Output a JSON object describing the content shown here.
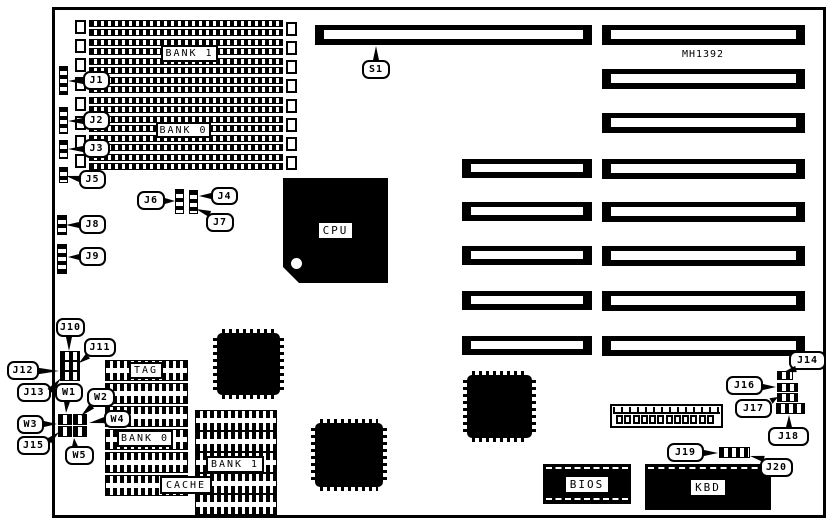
{
  "title": "MH1392 motherboard jumper and connector location diagram",
  "board": {
    "part_number": "MH1392",
    "part_number_pos": {
      "x": 672,
      "y": 49,
      "w": 62,
      "h": 14
    },
    "outline": {
      "x": 52,
      "y": 7,
      "w": 774,
      "h": 511
    },
    "ink_color": "#000000",
    "background_color": "#ffffff"
  },
  "memory": {
    "row": {
      "x": 75,
      "w": 222,
      "h": 16
    },
    "rows_y": [
      20,
      39,
      58,
      77,
      97,
      116,
      135,
      154
    ],
    "labels": [
      {
        "text": "BANK 1",
        "x": 161,
        "y": 45,
        "w": 57,
        "h": 17
      },
      {
        "text": "BANK 0",
        "x": 156,
        "y": 122,
        "w": 55,
        "h": 16
      }
    ]
  },
  "expansion_slots": [
    {
      "x": 315,
      "y": 25,
      "w": 277,
      "h": 20
    },
    {
      "x": 602,
      "y": 25,
      "w": 203,
      "h": 20
    },
    {
      "x": 602,
      "y": 69,
      "w": 203,
      "h": 20
    },
    {
      "x": 602,
      "y": 113,
      "w": 203,
      "h": 20
    },
    {
      "x": 462,
      "y": 159,
      "w": 130,
      "h": 19
    },
    {
      "x": 602,
      "y": 159,
      "w": 203,
      "h": 20
    },
    {
      "x": 462,
      "y": 202,
      "w": 130,
      "h": 19
    },
    {
      "x": 602,
      "y": 202,
      "w": 203,
      "h": 20
    },
    {
      "x": 462,
      "y": 246,
      "w": 130,
      "h": 19
    },
    {
      "x": 602,
      "y": 246,
      "w": 203,
      "h": 20
    },
    {
      "x": 462,
      "y": 291,
      "w": 130,
      "h": 19
    },
    {
      "x": 602,
      "y": 291,
      "w": 203,
      "h": 20
    },
    {
      "x": 462,
      "y": 336,
      "w": 130,
      "h": 19
    },
    {
      "x": 602,
      "y": 336,
      "w": 203,
      "h": 20
    }
  ],
  "chips": {
    "cpu": {
      "label": "CPU",
      "x": 283,
      "y": 178,
      "w": 105,
      "h": 105
    },
    "qfp": [
      {
        "x": 217,
        "y": 333,
        "w": 63,
        "h": 62
      },
      {
        "x": 315,
        "y": 423,
        "w": 68,
        "h": 64
      },
      {
        "x": 467,
        "y": 375,
        "w": 65,
        "h": 63
      }
    ],
    "bios": {
      "label": "BIOS",
      "x": 543,
      "y": 464,
      "w": 88,
      "h": 40
    },
    "kbd": {
      "label": "KBD",
      "x": 645,
      "y": 464,
      "w": 126,
      "h": 46
    }
  },
  "cache": {
    "rows": [
      {
        "x": 105,
        "y": 360,
        "w": 83,
        "h": 21
      },
      {
        "x": 105,
        "y": 383,
        "w": 83,
        "h": 21
      },
      {
        "x": 105,
        "y": 406,
        "w": 83,
        "h": 21
      },
      {
        "x": 105,
        "y": 429,
        "w": 83,
        "h": 21
      },
      {
        "x": 105,
        "y": 452,
        "w": 83,
        "h": 21
      },
      {
        "x": 105,
        "y": 475,
        "w": 83,
        "h": 21
      },
      {
        "x": 195,
        "y": 410,
        "w": 82,
        "h": 21
      },
      {
        "x": 195,
        "y": 431,
        "w": 82,
        "h": 21
      },
      {
        "x": 195,
        "y": 452,
        "w": 82,
        "h": 21
      },
      {
        "x": 195,
        "y": 473,
        "w": 82,
        "h": 21
      },
      {
        "x": 195,
        "y": 494,
        "w": 82,
        "h": 21
      }
    ],
    "labels": [
      {
        "text": "TAG",
        "x": 129,
        "y": 362,
        "w": 34,
        "h": 17
      },
      {
        "text": "BANK 0",
        "x": 117,
        "y": 430,
        "w": 56,
        "h": 17
      },
      {
        "text": "BANK 1",
        "x": 206,
        "y": 456,
        "w": 58,
        "h": 17
      },
      {
        "text": "CACHE",
        "x": 160,
        "y": 476,
        "w": 52,
        "h": 18
      }
    ]
  },
  "jumpers": [
    {
      "id": "J1",
      "dir": "v",
      "x": 59,
      "y": 66,
      "w": 9,
      "h": 29
    },
    {
      "id": "J2",
      "dir": "v",
      "x": 59,
      "y": 107,
      "w": 9,
      "h": 27
    },
    {
      "id": "J3",
      "dir": "v",
      "x": 59,
      "y": 140,
      "w": 9,
      "h": 19
    },
    {
      "id": "J5",
      "dir": "v",
      "x": 59,
      "y": 167,
      "w": 9,
      "h": 16
    },
    {
      "id": "J6",
      "dir": "v",
      "x": 175,
      "y": 189,
      "w": 9,
      "h": 25
    },
    {
      "id": "J4-J7",
      "dir": "v",
      "x": 189,
      "y": 190,
      "w": 9,
      "h": 24
    },
    {
      "id": "J8",
      "dir": "v",
      "x": 57,
      "y": 215,
      "w": 10,
      "h": 20
    },
    {
      "id": "J9",
      "dir": "v",
      "x": 57,
      "y": 244,
      "w": 10,
      "h": 30
    },
    {
      "id": "J10-J13-row1",
      "dir": "h",
      "x": 60,
      "y": 351,
      "w": 20,
      "h": 10
    },
    {
      "id": "J10-J13-row2",
      "dir": "h",
      "x": 60,
      "y": 361,
      "w": 20,
      "h": 10
    },
    {
      "id": "J10-J13-row3",
      "dir": "h",
      "x": 60,
      "y": 371,
      "w": 20,
      "h": 10
    },
    {
      "id": "W-block-1",
      "dir": "h",
      "x": 58,
      "y": 414,
      "w": 14,
      "h": 11
    },
    {
      "id": "W-block-2",
      "dir": "h",
      "x": 73,
      "y": 414,
      "w": 14,
      "h": 11
    },
    {
      "id": "W-block-3",
      "dir": "h",
      "x": 58,
      "y": 426,
      "w": 14,
      "h": 11
    },
    {
      "id": "W-block-4",
      "dir": "h",
      "x": 73,
      "y": 426,
      "w": 14,
      "h": 11
    },
    {
      "id": "J14",
      "dir": "h",
      "x": 777,
      "y": 371,
      "w": 16,
      "h": 9
    },
    {
      "id": "J16",
      "dir": "h",
      "x": 777,
      "y": 383,
      "w": 21,
      "h": 9
    },
    {
      "id": "J17",
      "dir": "h",
      "x": 777,
      "y": 393,
      "w": 21,
      "h": 9
    },
    {
      "id": "J18",
      "dir": "h",
      "x": 776,
      "y": 403,
      "w": 29,
      "h": 11
    },
    {
      "id": "J19",
      "dir": "h",
      "x": 719,
      "y": 447,
      "w": 31,
      "h": 11
    }
  ],
  "connector": {
    "x": 610,
    "y": 404,
    "w": 113,
    "h": 24,
    "pin_count": 12
  },
  "callouts": [
    {
      "label": "S1",
      "x": 362,
      "y": 60,
      "w": 28,
      "h": 19,
      "from": [
        376,
        61
      ],
      "tip": [
        376,
        46
      ]
    },
    {
      "label": "J1",
      "x": 83,
      "y": 71,
      "w": 27,
      "h": 19,
      "from": [
        84,
        81
      ],
      "tip": [
        68,
        81
      ]
    },
    {
      "label": "J2",
      "x": 83,
      "y": 111,
      "w": 27,
      "h": 19,
      "from": [
        84,
        121
      ],
      "tip": [
        68,
        121
      ]
    },
    {
      "label": "J3",
      "x": 83,
      "y": 139,
      "w": 27,
      "h": 19,
      "from": [
        84,
        149
      ],
      "tip": [
        68,
        149
      ]
    },
    {
      "label": "J5",
      "x": 79,
      "y": 170,
      "w": 27,
      "h": 19,
      "from": [
        80,
        179
      ],
      "tip": [
        66,
        176
      ]
    },
    {
      "label": "J6",
      "x": 137,
      "y": 191,
      "w": 28,
      "h": 19,
      "from": [
        164,
        201
      ],
      "tip": [
        175,
        201
      ]
    },
    {
      "label": "J4",
      "x": 211,
      "y": 187,
      "w": 27,
      "h": 18,
      "from": [
        212,
        196
      ],
      "tip": [
        199,
        196
      ]
    },
    {
      "label": "J7",
      "x": 206,
      "y": 213,
      "w": 28,
      "h": 19,
      "from": [
        210,
        214
      ],
      "tip": [
        196,
        209
      ]
    },
    {
      "label": "J8",
      "x": 79,
      "y": 215,
      "w": 27,
      "h": 19,
      "from": [
        80,
        225
      ],
      "tip": [
        66,
        225
      ]
    },
    {
      "label": "J9",
      "x": 79,
      "y": 247,
      "w": 27,
      "h": 19,
      "from": [
        80,
        257
      ],
      "tip": [
        68,
        257
      ]
    },
    {
      "label": "J10",
      "x": 56,
      "y": 318,
      "w": 29,
      "h": 19,
      "from": [
        69,
        336
      ],
      "tip": [
        69,
        351
      ]
    },
    {
      "label": "J11",
      "x": 84,
      "y": 338,
      "w": 32,
      "h": 19,
      "from": [
        88,
        356
      ],
      "tip": [
        79,
        363
      ]
    },
    {
      "label": "J12",
      "x": 7,
      "y": 361,
      "w": 32,
      "h": 19,
      "from": [
        38,
        371
      ],
      "tip": [
        59,
        371
      ]
    },
    {
      "label": "J13",
      "x": 17,
      "y": 383,
      "w": 34,
      "h": 19,
      "from": [
        50,
        391
      ],
      "tip": [
        61,
        378
      ]
    },
    {
      "label": "W1",
      "x": 55,
      "y": 383,
      "w": 28,
      "h": 19,
      "from": [
        67,
        401
      ],
      "tip": [
        66,
        413
      ]
    },
    {
      "label": "W2",
      "x": 87,
      "y": 388,
      "w": 28,
      "h": 19,
      "from": [
        92,
        406
      ],
      "tip": [
        81,
        416
      ]
    },
    {
      "label": "W3",
      "x": 17,
      "y": 415,
      "w": 27,
      "h": 19,
      "from": [
        43,
        424
      ],
      "tip": [
        57,
        424
      ]
    },
    {
      "label": "W4",
      "x": 104,
      "y": 410,
      "w": 27,
      "h": 18,
      "from": [
        105,
        420
      ],
      "tip": [
        89,
        423
      ]
    },
    {
      "label": "J15",
      "x": 17,
      "y": 436,
      "w": 33,
      "h": 19,
      "from": [
        49,
        441
      ],
      "tip": [
        59,
        432
      ]
    },
    {
      "label": "W5",
      "x": 65,
      "y": 446,
      "w": 29,
      "h": 19,
      "from": [
        75,
        447
      ],
      "tip": [
        74,
        438
      ]
    },
    {
      "label": "J14",
      "x": 789,
      "y": 351,
      "w": 37,
      "h": 19,
      "from": [
        796,
        369
      ],
      "tip": [
        784,
        372
      ]
    },
    {
      "label": "J16",
      "x": 726,
      "y": 376,
      "w": 37,
      "h": 19,
      "from": [
        762,
        387
      ],
      "tip": [
        776,
        387
      ]
    },
    {
      "label": "J17",
      "x": 735,
      "y": 399,
      "w": 37,
      "h": 19,
      "from": [
        771,
        401
      ],
      "tip": [
        778,
        397
      ]
    },
    {
      "label": "J18",
      "x": 768,
      "y": 427,
      "w": 41,
      "h": 19,
      "from": [
        789,
        428
      ],
      "tip": [
        789,
        415
      ]
    },
    {
      "label": "J19",
      "x": 667,
      "y": 443,
      "w": 37,
      "h": 19,
      "from": [
        703,
        453
      ],
      "tip": [
        718,
        453
      ]
    },
    {
      "label": "J20",
      "x": 760,
      "y": 458,
      "w": 33,
      "h": 19,
      "from": [
        764,
        459
      ],
      "tip": [
        750,
        456
      ]
    }
  ]
}
